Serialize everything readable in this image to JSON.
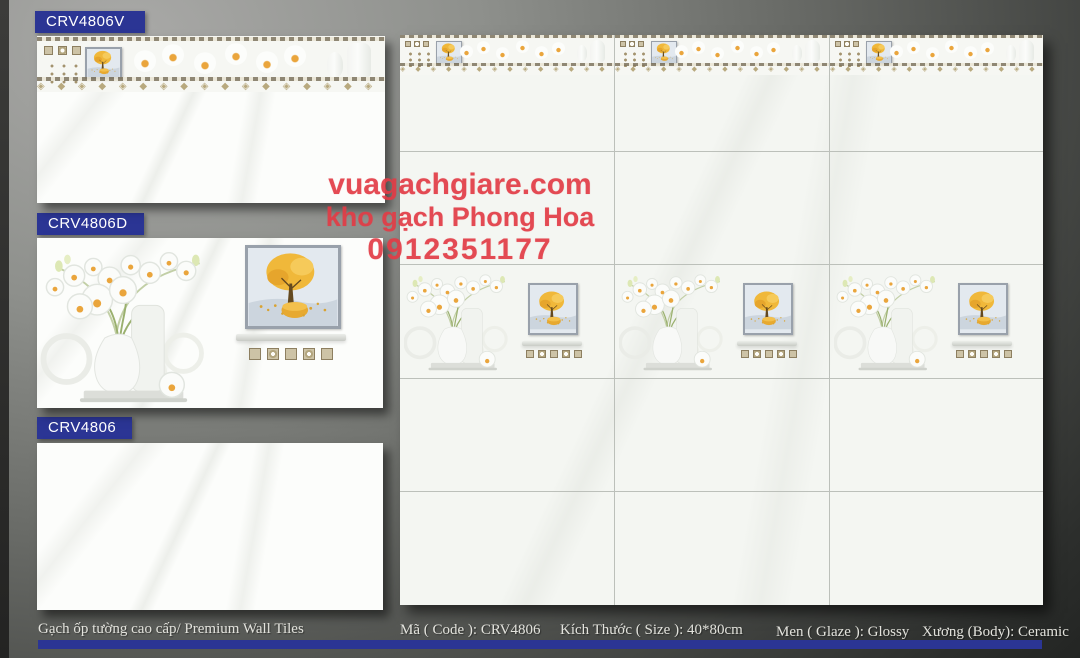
{
  "products": [
    {
      "code": "CRV4806V",
      "type": "border-tile"
    },
    {
      "code": "CRV4806D",
      "type": "decor-tile"
    },
    {
      "code": "CRV4806",
      "type": "plain-tile"
    }
  ],
  "watermark": {
    "website": "vuagachgiare.com",
    "store": "kho gạch Phong Hoa",
    "phone": "0912351177",
    "color": "#e23c46"
  },
  "footer": {
    "category": "Gạch ốp tường cao cấp/ Premium Wall Tiles",
    "code": "Mã ( Code ): CRV4806",
    "size": "Kích Thước ( Size ): 40*80cm",
    "glaze": "Men ( Glaze ): Glossy",
    "body": "Xương (Body): Ceramic"
  },
  "colors": {
    "banner": "#2b3594",
    "stripe": "#2b3594",
    "grout_line": "#bcc0ba",
    "accent_gold": "#eaa53c"
  },
  "decor": {
    "diamond_row_lg": "◈ ◆ ◈ ◆ ◈ ◆ ◈ ◆ ◈ ◆ ◈ ◆ ◈ ◆ ◈ ◆ ◈ ◆ ◈ ◆ ◈ ◆ ◈ ◆ ◈ ◆",
    "diamond_row_sm": "◈ ◆ ◈ ◆ ◈ ◆ ◈ ◆ ◈ ◆ ◈ ◆ ◈ ◆ ◈ ◆"
  }
}
